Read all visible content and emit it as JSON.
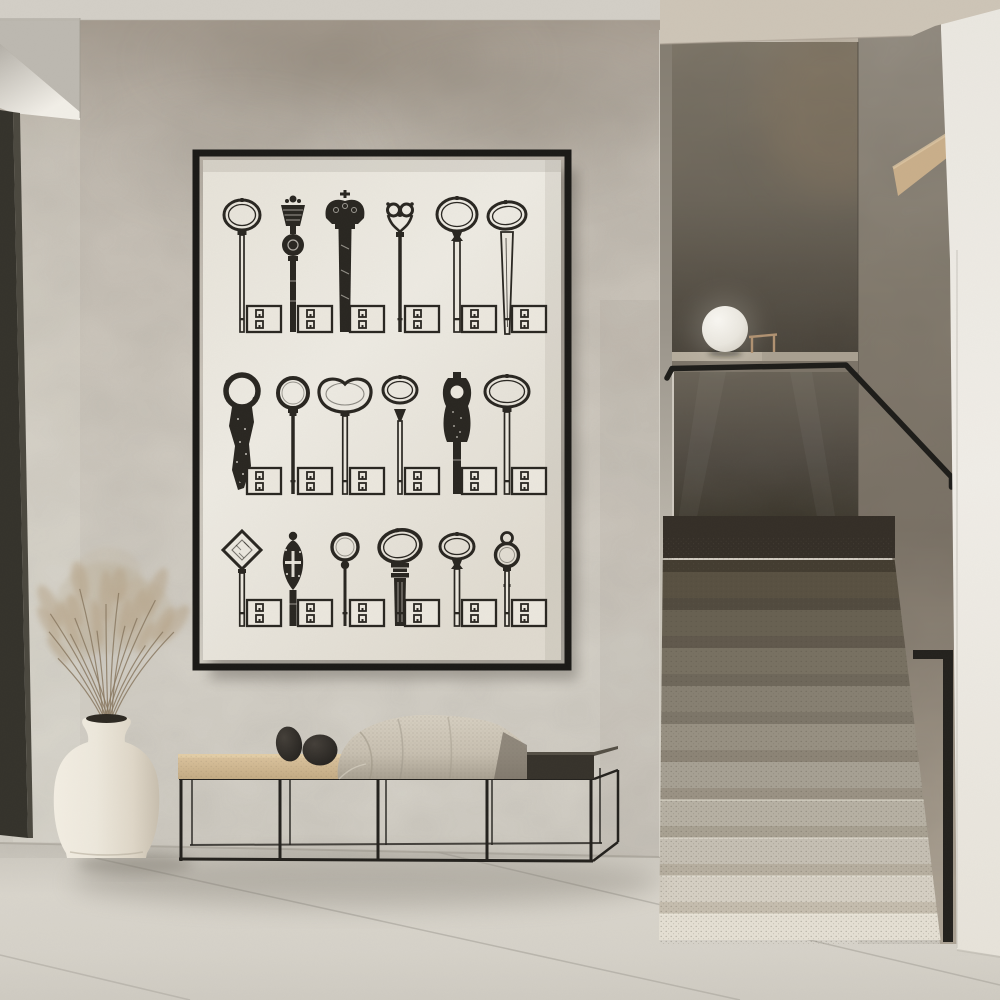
{
  "scene": {
    "description": "Minimalist concrete-plaster hallway. A black thin-framed poster shows 18 antique keys whose tips are USB plugs, arranged 3 rows by 6 columns on ivory paper. Below it a black metal slat bench with a tan cushion, a draped knit throw and two black pebble sculptures. Left: a white ceramic vase with dried pampas grass on a terrazzo tile floor, beside a dark door reveal. Right: a terrazzo staircase rising into shadow with a black metal handrail, smoked parapet wall, a white sphere lamp and a small wooden stand on the half-wall ledge, bounded by a bright white near wall.",
    "objects": [
      "poster-artwork",
      "bench",
      "knit-throw",
      "pebbles",
      "vase",
      "dried-grass",
      "door-reveal",
      "staircase",
      "handrail",
      "sphere-lamp",
      "wood-stand",
      "wood-shelf"
    ]
  },
  "palette": {
    "ink": "#2a2722",
    "paper": "#eae6dd",
    "frame": "#1b1a17",
    "wall_top": "#a89e92",
    "wall_mid": "#cfc9bf",
    "wall_base": "#d7d3ca",
    "wall_stain": "#857b6d",
    "ceiling": "#d2cec6",
    "ceiling_right": "#cdc4b6",
    "cove_bright": "#f1eee7",
    "cove_shadow": "#b4b0a8",
    "door_dark": "#35332c",
    "door_edge": "#4c4940",
    "floor_edge": "#c9c5bc",
    "floor_light": "#d9d5cc",
    "floor_low": "#cfcbc2",
    "seam": "#b2aea5",
    "jamb_top": "#847d71",
    "jamb_bottom": "#dcd8ce",
    "panel_top": "#80786a",
    "panel_mid": "#6d665a",
    "panel_bottom": "#453f36",
    "panel_warm": "#8a7860",
    "ledge_top": "#a89f90",
    "ledge_face": "#7c7468",
    "glass_top": "#6a6357",
    "glass_mid": "#4e4840",
    "glass_bottom": "#393429",
    "shadow_band": "#352f28",
    "col_top": "#958e83",
    "col_mid": "#7c7367",
    "col_bottom": "#b6ac9d",
    "wood_wedge": "#c9ae8a",
    "wood_wedge_light": "#dcc5a2",
    "white_top": "#eae7e0",
    "white_mid": "#f0ede7",
    "white_bottom": "#e7e3da",
    "rail": "#1e1d1a",
    "step_riser_light": "#e4dfd3",
    "step_riser_dark": "#595142",
    "step_tread_light": "#c5bdae",
    "step_tread_dark": "#443d31",
    "sphere": "#f8f6f1",
    "sphere_edge": "#cfcabf",
    "stand_wood": "#b09272",
    "bench_metal": "#24221e",
    "cushion_light": "#dcc49e",
    "cushion_dark": "#c3ab84",
    "bench_top_dark": "#37332c",
    "bench_top_edge": "#555046",
    "blanket_light": "#d6cfc1",
    "blanket_mid": "#c7bfb0",
    "blanket_dark": "#a79f90",
    "blanket_fold": "#6e675c",
    "pebble_light": "#45403a",
    "pebble_dark": "#1f1d1a",
    "vase_light": "#f2ede2",
    "vase_mid": "#ece7db",
    "vase_shade": "#ded6c7",
    "vase_dark": "#c7beae",
    "vase_mouth": "#2e2a23",
    "grass": "#b5a286",
    "grass_stem": "#8a7962",
    "shadow": "#6e695f"
  },
  "poster": {
    "grid": {
      "rows": 3,
      "cols": 6,
      "total_keys": 18
    },
    "col_centers": [
      39,
      90,
      142,
      197,
      254,
      304
    ],
    "row_baselines": [
      172,
      334,
      466
    ],
    "usb": {
      "w": 34,
      "h": 26
    },
    "keys": [
      {
        "bow": "oval",
        "top": 40,
        "w": 36,
        "h": 30,
        "shaft": 4
      },
      {
        "bow": "baroque",
        "top": 36
      },
      {
        "bow": "crown",
        "top": 30
      },
      {
        "bow": "scroll",
        "top": 42,
        "shaft": 3.5
      },
      {
        "bow": "oval",
        "top": 38,
        "w": 40,
        "h": 33,
        "shaft": 6,
        "baluster": true
      },
      {
        "bow": "blade",
        "top": 42,
        "w": 38,
        "h": 27
      },
      {
        "bow": "rugged",
        "top": 214
      },
      {
        "bow": "ring",
        "top": 218,
        "r": 15,
        "shaft": 3.5
      },
      {
        "bow": "kidney",
        "top": 219,
        "shaft": 4.5
      },
      {
        "bow": "spear",
        "top": 217,
        "w": 34,
        "h": 26,
        "shaft": 4
      },
      {
        "bow": "figure",
        "top": 212
      },
      {
        "bow": "oval",
        "top": 216,
        "w": 44,
        "h": 31,
        "shaft": 5
      },
      {
        "bow": "diamond",
        "top": 371,
        "shaft": 4.5
      },
      {
        "bow": "pierced",
        "top": 372
      },
      {
        "bow": "ring",
        "top": 374,
        "r": 13,
        "shaft": 3,
        "ball": true
      },
      {
        "bow": "ribbed",
        "top": 370,
        "w": 42,
        "h": 32
      },
      {
        "bow": "oval",
        "top": 374,
        "w": 34,
        "h": 25,
        "shaft": 5,
        "baluster": true
      },
      {
        "bow": "loopring",
        "top": 372
      }
    ]
  }
}
